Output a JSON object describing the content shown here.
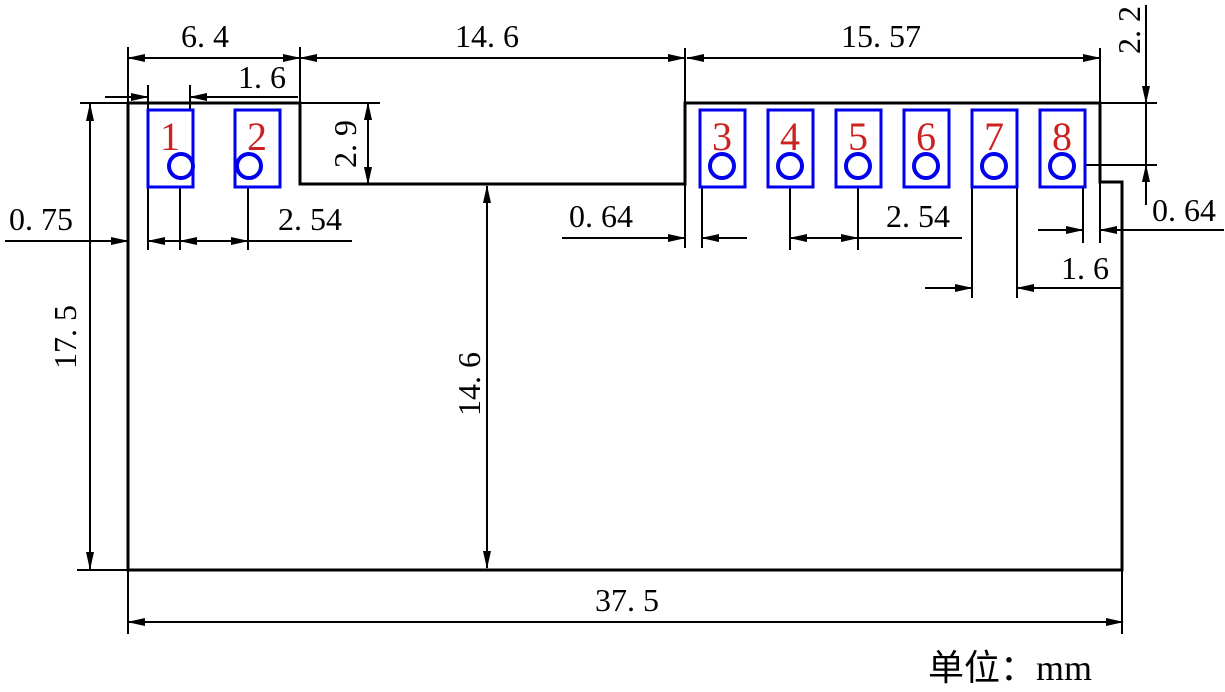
{
  "drawing": {
    "title": "pcb-module-footprint-dimension-drawing",
    "units_note": "单位：mm",
    "unit": "mm",
    "colors": {
      "pad_outline": "#0000ee",
      "pin_number": "#cc2222",
      "line": "#000000",
      "background": "#ffffff"
    },
    "pads": [
      {
        "pin": "1"
      },
      {
        "pin": "2"
      },
      {
        "pin": "3"
      },
      {
        "pin": "4"
      },
      {
        "pin": "5"
      },
      {
        "pin": "6"
      },
      {
        "pin": "7"
      },
      {
        "pin": "8"
      }
    ],
    "dimensions": {
      "left_section_width": {
        "label": "6. 4",
        "value": 6.4,
        "orientation": "horizontal"
      },
      "pad1_width": {
        "label": "1. 6",
        "value": 1.6,
        "orientation": "horizontal"
      },
      "notch_width": {
        "label": "14. 6",
        "value": 14.6,
        "orientation": "horizontal"
      },
      "right_section_width": {
        "label": "15. 57",
        "value": 15.57,
        "orientation": "horizontal"
      },
      "top_edge_to_hole_row": {
        "label": "2. 2",
        "value": 2.2,
        "orientation": "vertical"
      },
      "notch_depth": {
        "label": "2. 9",
        "value": 2.9,
        "orientation": "vertical"
      },
      "edge_to_pad1": {
        "label": "0. 75",
        "value": 0.75,
        "orientation": "horizontal"
      },
      "hole_pitch_left": {
        "label": "2. 54",
        "value": 2.54,
        "orientation": "horizontal"
      },
      "notch_to_pad3": {
        "label": "0. 64",
        "value": 0.64,
        "orientation": "horizontal"
      },
      "hole_pitch_right": {
        "label": "2. 54",
        "value": 2.54,
        "orientation": "horizontal"
      },
      "pad7_width": {
        "label": "1. 6",
        "value": 1.6,
        "orientation": "horizontal"
      },
      "pad8_to_edge": {
        "label": "0. 64",
        "value": 0.64,
        "orientation": "horizontal"
      },
      "overall_height": {
        "label": "17. 5",
        "value": 17.5,
        "orientation": "vertical"
      },
      "notch_floor_to_bottom": {
        "label": "14. 6",
        "value": 14.6,
        "orientation": "vertical"
      },
      "overall_width": {
        "label": "37. 5",
        "value": 37.5,
        "orientation": "horizontal"
      }
    }
  }
}
